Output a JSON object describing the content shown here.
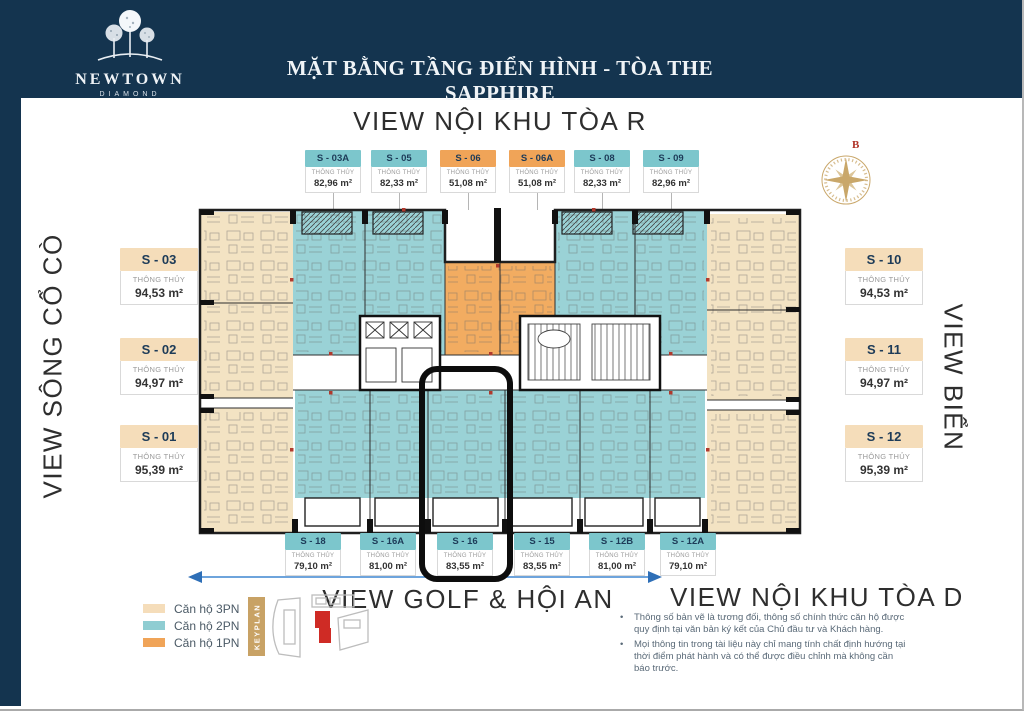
{
  "header": {
    "logo_name": "NEWTOWN",
    "logo_sub": "DIAMOND",
    "title": "MẶT BẰNG TẦNG ĐIỂN HÌNH - TÒA THE SAPPHIRE"
  },
  "views": {
    "top": "VIEW NỘI KHU TÒA R",
    "left": "VIEW SÔNG CỔ CÒ",
    "right": "VIEW BIỂN",
    "bottom_center": "VIEW GOLF & HỘI AN",
    "bottom_right": "VIEW NỘI KHU TÒA D"
  },
  "compass": {
    "north_label": "B"
  },
  "units": {
    "measure_label": "THÔNG THỦY",
    "top": [
      {
        "code": "S - 03A",
        "area": "82,96 m²",
        "type": "2PN"
      },
      {
        "code": "S - 05",
        "area": "82,33 m²",
        "type": "2PN"
      },
      {
        "code": "S - 06",
        "area": "51,08 m²",
        "type": "1PN"
      },
      {
        "code": "S - 06A",
        "area": "51,08 m²",
        "type": "1PN"
      },
      {
        "code": "S - 08",
        "area": "82,33 m²",
        "type": "2PN"
      },
      {
        "code": "S - 09",
        "area": "82,96 m²",
        "type": "2PN"
      }
    ],
    "left": [
      {
        "code": "S - 03",
        "area": "94,53 m²",
        "type": "3PN"
      },
      {
        "code": "S - 02",
        "area": "94,97 m²",
        "type": "3PN"
      },
      {
        "code": "S - 01",
        "area": "95,39 m²",
        "type": "3PN"
      }
    ],
    "right": [
      {
        "code": "S - 10",
        "area": "94,53 m²",
        "type": "3PN"
      },
      {
        "code": "S - 11",
        "area": "94,97 m²",
        "type": "3PN"
      },
      {
        "code": "S - 12",
        "area": "95,39 m²",
        "type": "3PN"
      }
    ],
    "bottom": [
      {
        "code": "S - 18",
        "area": "79,10 m²",
        "type": "2PN"
      },
      {
        "code": "S - 16A",
        "area": "81,00 m²",
        "type": "2PN"
      },
      {
        "code": "S - 16",
        "area": "83,55 m²",
        "type": "2PN",
        "highlighted": true
      },
      {
        "code": "S - 15",
        "area": "83,55 m²",
        "type": "2PN"
      },
      {
        "code": "S - 12B",
        "area": "81,00 m²",
        "type": "2PN"
      },
      {
        "code": "S - 12A",
        "area": "79,10 m²",
        "type": "2PN"
      }
    ]
  },
  "legend": {
    "items": [
      {
        "label": "Căn hộ 3PN",
        "color": "#f5ddba"
      },
      {
        "label": "Căn hộ 2PN",
        "color": "#8fcdd2"
      },
      {
        "label": "Căn hộ 1PN",
        "color": "#f0a458"
      }
    ],
    "keyplan_label": "KEYPLAN"
  },
  "notes": [
    "Thông số bản vẽ là tương đối, thông số chính thức căn hộ được quy định tại văn bản ký kết của Chủ đầu tư và Khách hàng.",
    "Mọi thông tin trong tài liệu này chỉ mang tính chất định hướng tại thời điểm phát hành và có thể được điều chỉnh mà không cần báo trước."
  ],
  "colors": {
    "navy": "#14344f",
    "teal": "#9ad2d6",
    "orange": "#f2ac61",
    "beige": "#f3e3c3",
    "gold": "#c8a265",
    "red_marker": "#b03a2e",
    "arrow_blue": "#2e6fb7"
  }
}
